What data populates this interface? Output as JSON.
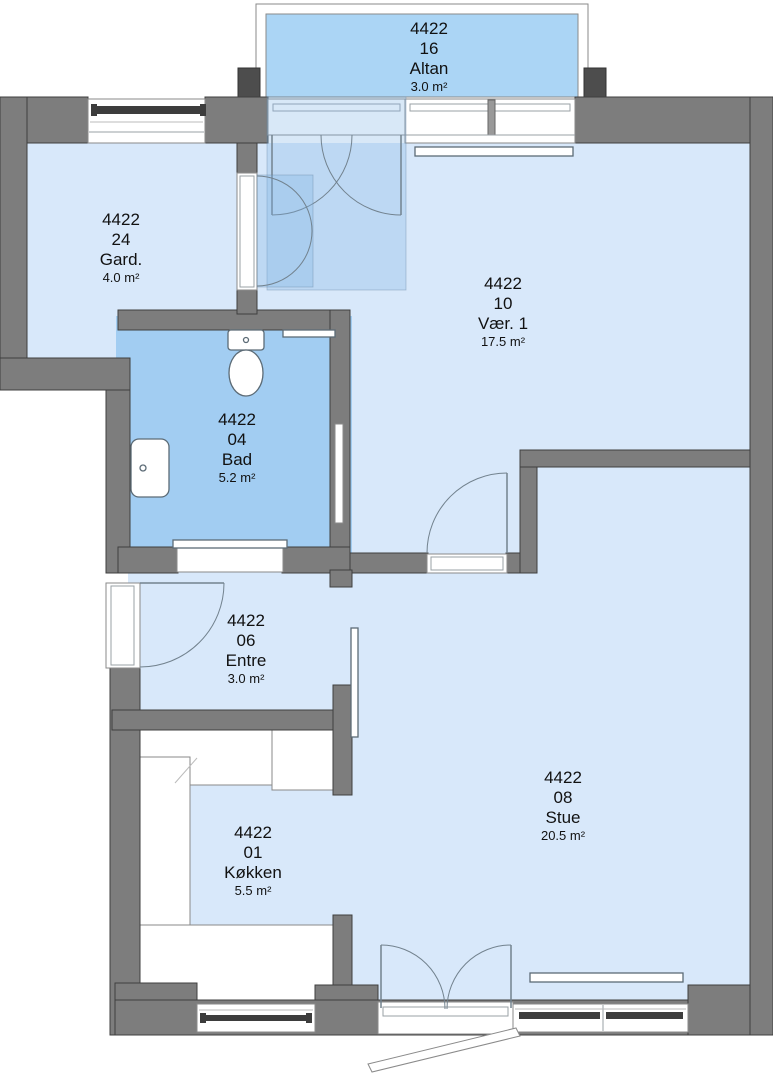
{
  "unit_id": "4422",
  "plan": {
    "rooms": [
      {
        "id": "4422",
        "number": "16",
        "name": "Altan",
        "area": "3.0 m²"
      },
      {
        "id": "4422",
        "number": "24",
        "name": "Gard.",
        "area": "4.0 m²"
      },
      {
        "id": "4422",
        "number": "10",
        "name": "Vær. 1",
        "area": "17.5 m²"
      },
      {
        "id": "4422",
        "number": "04",
        "name": "Bad",
        "area": "5.2 m²"
      },
      {
        "id": "4422",
        "number": "06",
        "name": "Entre",
        "area": "3.0 m²"
      },
      {
        "id": "4422",
        "number": "01",
        "name": "Køkken",
        "area": "5.5 m²"
      },
      {
        "id": "4422",
        "number": "08",
        "name": "Stue",
        "area": "20.5 m²"
      }
    ],
    "colors": {
      "wall": "#7d7d7d",
      "room": "#d8e8fa",
      "bathroom": "#a2cdf2",
      "balcony": "#abd5f5",
      "text": "#111111"
    }
  }
}
